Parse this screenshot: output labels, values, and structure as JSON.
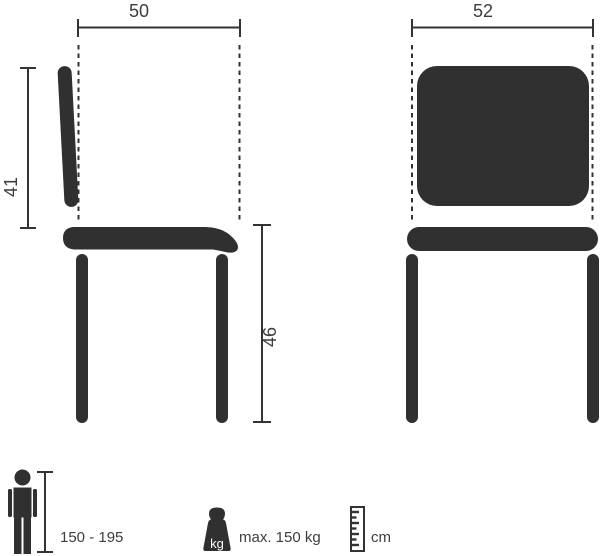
{
  "diagram": {
    "title": "chair dimension diagram",
    "side_view": {
      "width_label": "50",
      "backrest_height_label": "41",
      "seat_height_label": "46"
    },
    "front_view": {
      "width_label": "52"
    },
    "legend": {
      "person": {
        "icon": "person-icon",
        "label": "150 - 195"
      },
      "weight": {
        "icon": "weight-kg-icon",
        "badge": "kg",
        "label": "max. 150 kg"
      },
      "ruler": {
        "icon": "ruler-icon",
        "label": "cm"
      }
    },
    "colors": {
      "shape": "#303030",
      "line": "#333333",
      "text": "#3d3d3d",
      "background": "#ffffff"
    }
  }
}
